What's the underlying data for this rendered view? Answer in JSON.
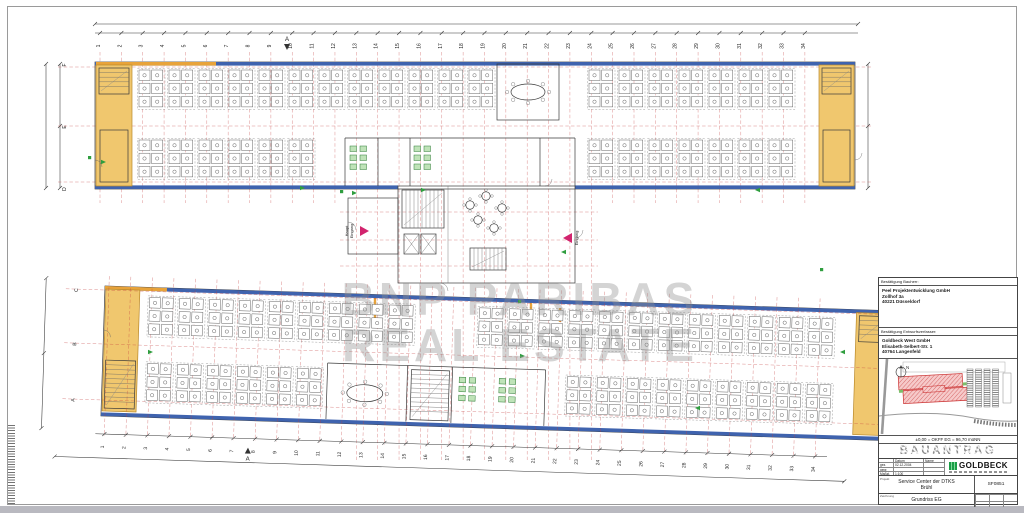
{
  "watermark": {
    "line1": "BNP PARIBAS",
    "line2": "REAL ESTATE"
  },
  "plan": {
    "axis_numbers": [
      "1",
      "2",
      "3",
      "4",
      "5",
      "6",
      "7",
      "8",
      "9",
      "10",
      "11",
      "12",
      "13",
      "14",
      "15",
      "16",
      "17",
      "18",
      "19",
      "20",
      "21",
      "22",
      "23",
      "24",
      "25",
      "26",
      "27",
      "28",
      "29",
      "30",
      "31",
      "32",
      "33",
      "34"
    ],
    "top_row_letters": [
      "F",
      "E",
      "D"
    ],
    "bottom_row_letters": [
      "C",
      "B",
      "A"
    ],
    "section_label": "A",
    "entrance_main_line1": "Haupt",
    "entrance_main_line2": "Eingang",
    "entrance_side": "Eingang"
  },
  "title_block": {
    "owner_header": "Bestätigung  Bauherr:",
    "owner_lines": [
      "Peel Projektentwicklung GmbH",
      "Zollhof 3a",
      "40221 Düsseldorf"
    ],
    "designer_header": "Bestätigung  Entwurfsverfasser:",
    "designer_lines": [
      "Goldbeck West GmbH",
      "Elisabeth-Selbert-Str. 1",
      "40764 Langenfeld"
    ],
    "north_label": "N",
    "level_note": "±0,00  =  OKFF EG  =  96,70 müNN",
    "stamp": "BAUANTRAG",
    "logo_text": "GOLDBECK",
    "meta": {
      "col_datum": "Datum",
      "col_name": "Name",
      "row_gez": "gez.",
      "date": "02.12.2004",
      "row_gepr": "gepr.",
      "row_scale": "Maßst.",
      "scale": "1:100"
    },
    "project_label": "Projekt",
    "project_line1": "Service Center der DTKS",
    "project_line2": "Brühl",
    "title_label": "Zeichnung",
    "drawing_title": "Grundriss EG",
    "drawing_no": "SF0851"
  }
}
